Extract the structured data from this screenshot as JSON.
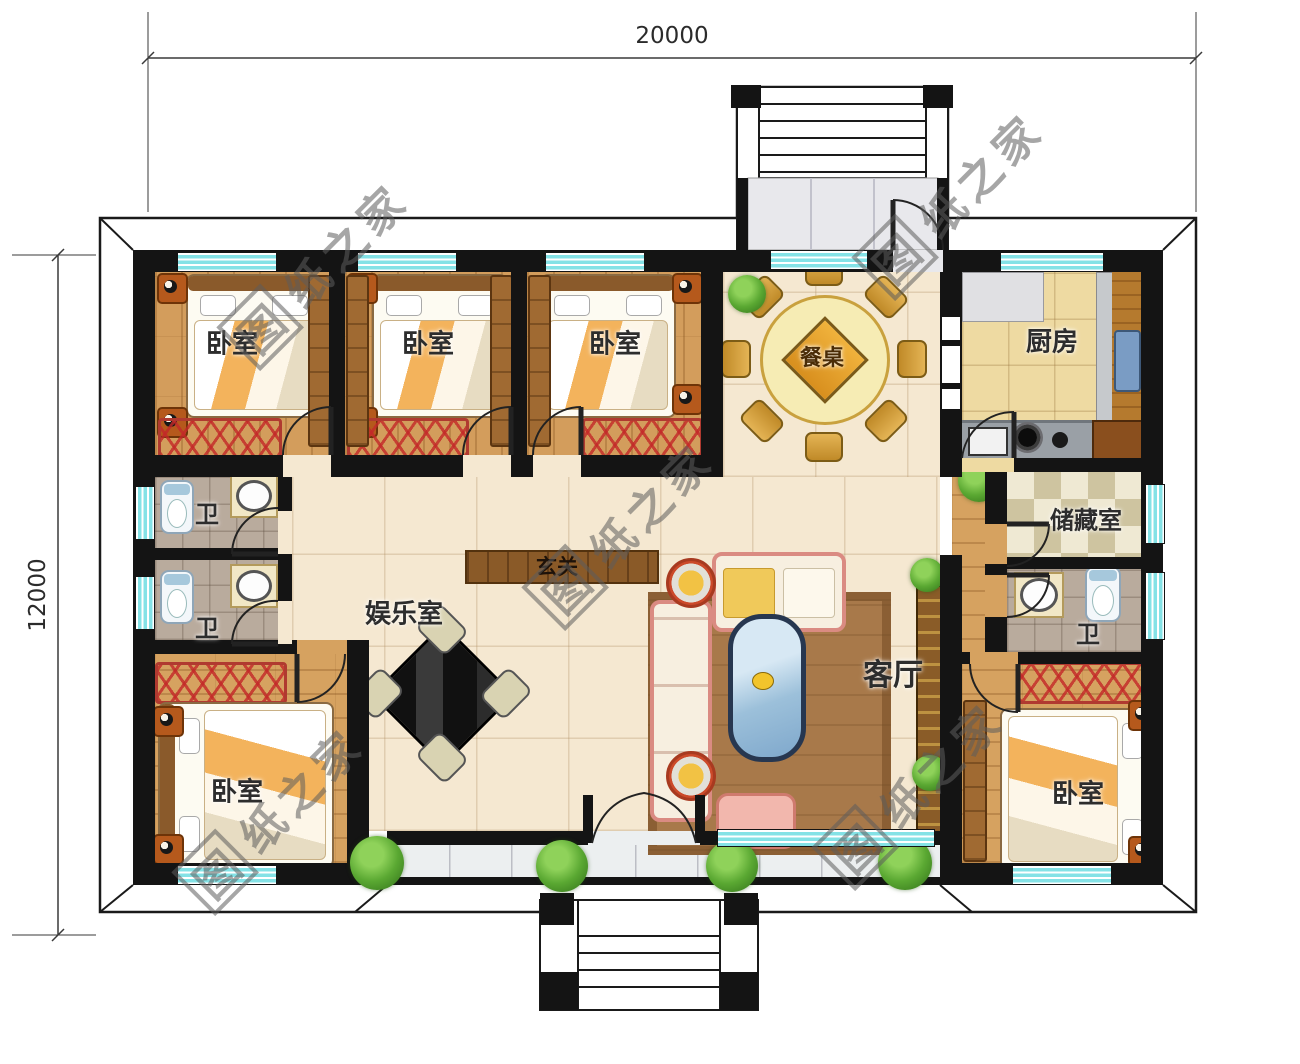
{
  "dimensions": {
    "top": "20000",
    "left": "12000"
  },
  "watermark": {
    "first_char": "图",
    "rest_chars": "纸之家",
    "full_text": "图纸之家"
  },
  "rooms": {
    "bedroom_top_left": {
      "label": "卧室"
    },
    "bedroom_top_middle": {
      "label": "卧室"
    },
    "bedroom_top_right": {
      "label": "卧室"
    },
    "dining_table": {
      "label": "餐桌"
    },
    "kitchen": {
      "label": "厨房"
    },
    "storage": {
      "label": "储藏室"
    },
    "bath_right": {
      "label": "卫"
    },
    "bedroom_bottom_right": {
      "label": "卧室"
    },
    "bath_left_upper": {
      "label": "卫"
    },
    "bath_left_lower": {
      "label": "卫"
    },
    "entertainment": {
      "label": "娱乐室"
    },
    "foyer": {
      "label": "玄关"
    },
    "living": {
      "label": "客厅"
    },
    "bedroom_bottom_left": {
      "label": "卧室"
    }
  },
  "colors": {
    "wall": "#141414",
    "window_cyan": "#84e2e6",
    "wood_floor": "#d39d5c",
    "hall_floor": "#f5e8d1",
    "kitchen_floor": "#eedaa2",
    "stone_floor": "#b9ab9d",
    "checker": "#cec4a0",
    "marble": "#eceff0",
    "bench_red": "#b03a30",
    "sofa_pink": "#da8b82",
    "table_gold": "#e2a93c",
    "plant_green": "#5aa832"
  }
}
